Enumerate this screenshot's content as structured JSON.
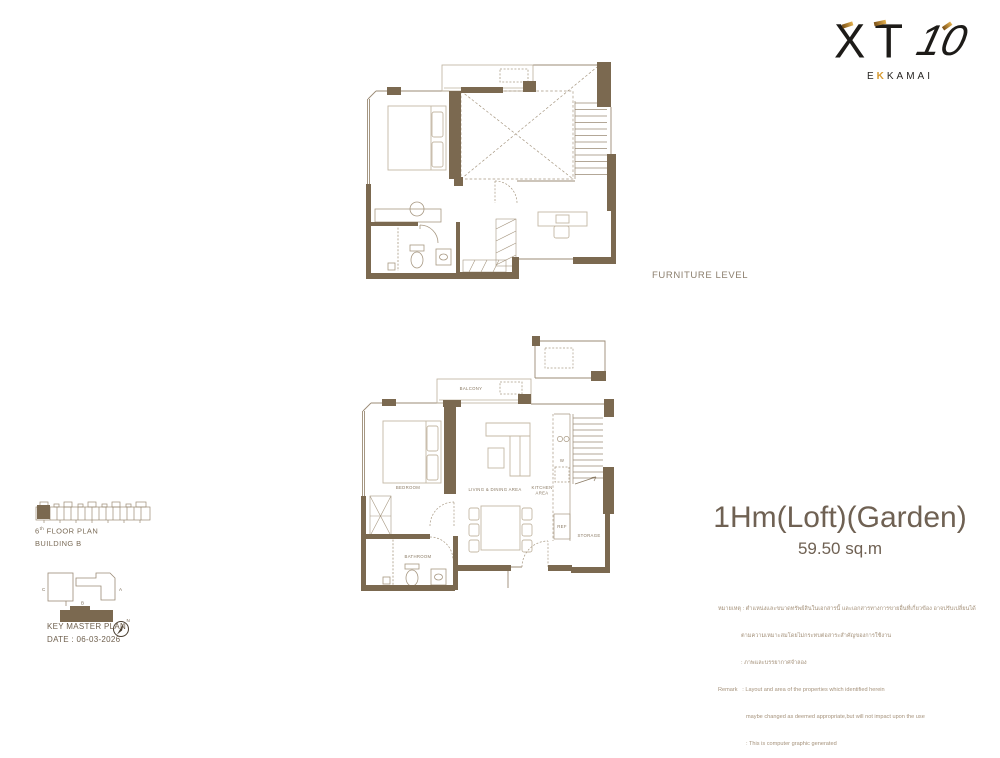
{
  "logo": {
    "xt": "XT",
    "ten": "10",
    "sub_e": "E",
    "sub_k": "K",
    "sub_rest": "KAMAI"
  },
  "furniture_level_label": "FURNITURE LEVEL",
  "unit": {
    "title": "1Hm(Loft)(Garden)",
    "area": "59.50 sq.m"
  },
  "remark": {
    "lines": [
      "หมายเหตุ : ตำแหน่งและขนาดทรัพย์สินในเอกสารนี้ และเอกสารทางการขายอื่นที่เกี่ยวข้อง อาจปรับเปลี่ยนได้",
      "ตามความเหมาะสมโดยไม่กระทบต่อสาระสำคัญของการใช้งาน",
      ": ภาพและบรรยากาศจำลอง",
      "Remark   : Layout and area of the properties which identified herein",
      "maybe changed as deemed appropriate,but will not impact upon the use",
      ": This is computer graphic generated"
    ]
  },
  "key_plan": {
    "floor_num": "6",
    "floor_sup": "th",
    "floor_text": " FLOOR PLAN",
    "building": "BUILDING B",
    "master_title": "KEY MASTER PLAN",
    "date": "DATE : 06-03-2026",
    "building_a": "A",
    "building_b": "B",
    "building_c": "C",
    "north": "N"
  },
  "plan_labels": {
    "balcony": "BALCONY",
    "bedroom": "BEDROOM",
    "living": "LIVING  & DINING AREA",
    "kitchen_line1": "KITCHEN",
    "kitchen_line2": "AREA",
    "bathroom": "BATHROOM",
    "storage": "STORAGE",
    "ref": "REF",
    "washer": "W"
  },
  "colors": {
    "wall_brown": "#7b6950",
    "plan_line": "#9b8b76",
    "furniture_line": "#c4b8a5",
    "title_text": "#6f6153",
    "remark_text": "#a5927b",
    "logo_gold": "#d79a2f"
  }
}
